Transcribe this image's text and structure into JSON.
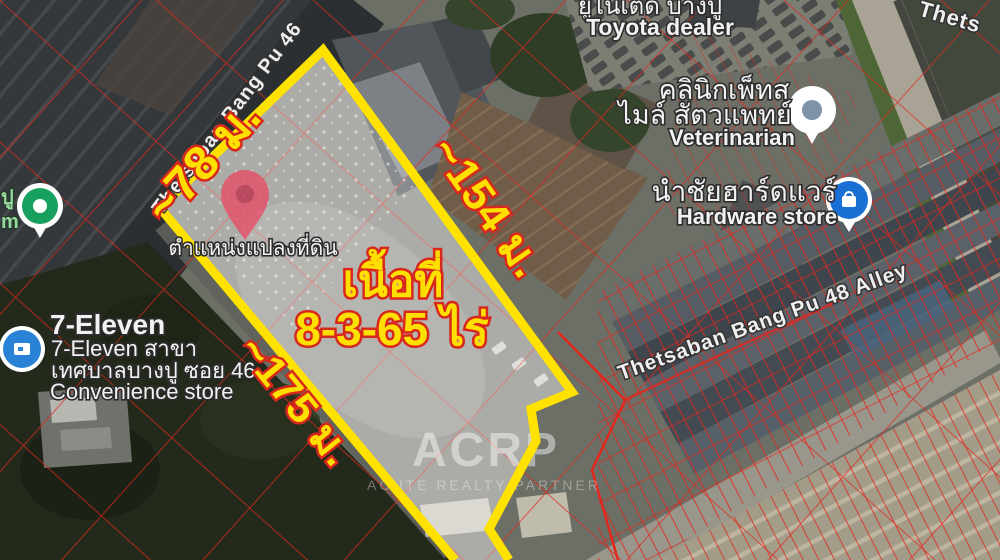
{
  "plot": {
    "area_label": {
      "line1": "เนื้อที่",
      "line2": "8-3-65 ไร่"
    },
    "dimensions": {
      "top": "~78 ม.",
      "right": "~154 ม.",
      "left": "~175 ม."
    },
    "pin_caption": "ตำแหน่งแปลงที่ดิน",
    "outline_color": "#ffe200"
  },
  "streets": {
    "bang_pu_46": "Thetsaban Bang Pu 46",
    "bang_pu_48": "Thetsaban Bang Pu 48 Alley",
    "top_right_partial": "Thets"
  },
  "places": {
    "toyota": {
      "thai": "ยูไนเต็ด บางปู",
      "en": "Toyota dealer"
    },
    "vet": {
      "thai_line1": "คลินิกเพ็ทส",
      "thai_line2": "ไมล์ สัตวแพทย์",
      "en": "Veterinarian"
    },
    "hardware": {
      "thai": "นำชัยฮาร์ดแวร์",
      "en": "Hardware store"
    },
    "seven_eleven": {
      "name": "7-Eleven",
      "line2": "7-Eleven สาขา",
      "line3": "เทศบาลบางปู ซอย 46...",
      "line4": "Convenience store"
    },
    "left_edge_partial": {
      "line1": "ปู",
      "line2": "m"
    }
  },
  "watermark": {
    "logo": "ACRP",
    "tagline": "ACUTE REALTY PARTNER"
  },
  "colors": {
    "cadastral_lines": "#e3271d",
    "dimension_text": "#ffdf00",
    "dimension_outline": "#d8271c",
    "pin": "#e2556b",
    "plot_fill": "rgba(255,255,255,0.32)"
  }
}
